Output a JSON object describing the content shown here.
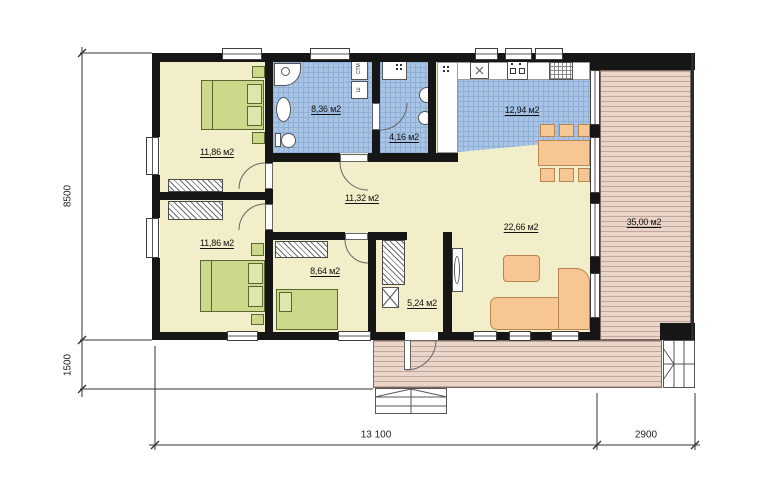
{
  "plan_title": "single-storey house floor plan",
  "rooms": [
    {
      "name": "bedroom-1",
      "area_label": "11,86 м2"
    },
    {
      "name": "bathroom",
      "area_label": "8,36 м2"
    },
    {
      "name": "wc",
      "area_label": "4,16 м2"
    },
    {
      "name": "kitchen",
      "area_label": "12,94 м2"
    },
    {
      "name": "hall",
      "area_label": "11,32 м2"
    },
    {
      "name": "bedroom-2",
      "area_label": "11,86 м2"
    },
    {
      "name": "kids-room",
      "area_label": "8,64 м2"
    },
    {
      "name": "entrance-hall",
      "area_label": "5,24 м2"
    },
    {
      "name": "living-room",
      "area_label": "22,66 м2"
    },
    {
      "name": "terrace",
      "area_label": "35,00 м2"
    }
  ],
  "dimensions": {
    "height_main": "8500",
    "height_porch": "1500",
    "width_main": "13 100",
    "width_terrace": "2900"
  },
  "appliance_labels": {
    "washing_machine": "СТМ",
    "closet": "Ш"
  },
  "colors": {
    "wall": "#161616",
    "floor": "#f2eec9",
    "tile": "#a9c4e4",
    "tile_line": "#8fb0d6",
    "deck": "#e9d5ca",
    "deck_line": "#c4a698",
    "green": "#ccd98b",
    "green_lite": "#dde7ad",
    "green_line": "#5c6430",
    "orange": "#f6c795",
    "orange_line": "#b9854e"
  }
}
